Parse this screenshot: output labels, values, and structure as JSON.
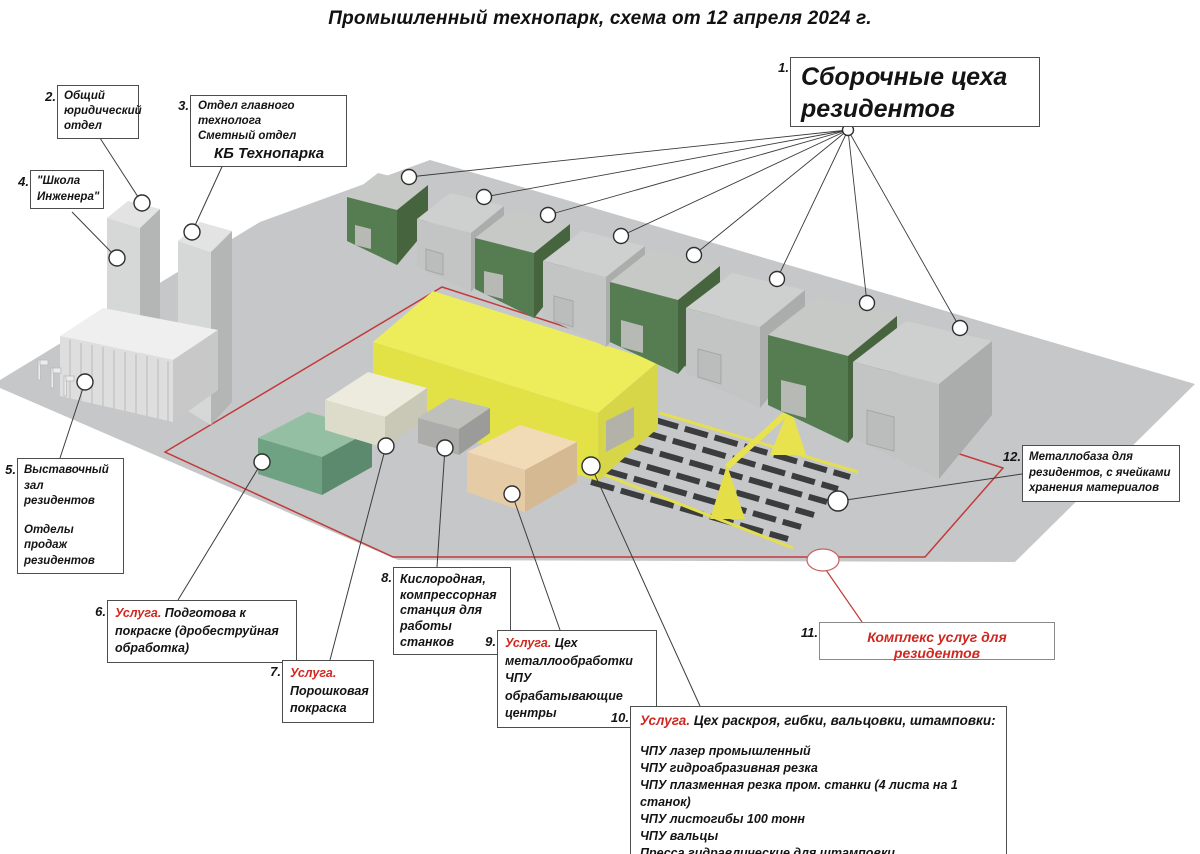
{
  "title": "Промышленный технопарк, схема от 12 апреля 2024 г.",
  "colors": {
    "service_red": "#d02820",
    "zone_outline": "#c23b3b",
    "assembly_green": "#567d52",
    "assembly_gray": "#c3c5c4",
    "main_workshop_yellow": "#e2e246"
  },
  "callouts": {
    "c1": {
      "num": "1.",
      "line1": "Сборочные цеха",
      "line2": "резидентов"
    },
    "c2": {
      "num": "2.",
      "text": "Общий юридический отдел"
    },
    "c3": {
      "num": "3.",
      "line1": "Отдел главного технолога",
      "line2": "Сметный отдел",
      "line3": "КБ Технопарка"
    },
    "c4": {
      "num": "4.",
      "line1": "\"Школа",
      "line2": "Инженера\""
    },
    "c5": {
      "num": "5.",
      "line1": "Выставочный зал",
      "line2": "резидентов",
      "line3": "Отделы продаж",
      "line4": "резидентов"
    },
    "c6": {
      "num": "6.",
      "prefix": "Услуга.",
      "text": " Подготова к покраске (дробеструйная обработка)"
    },
    "c7": {
      "num": "7.",
      "prefix": "Услуга.",
      "text": "Порошковая покраска"
    },
    "c8": {
      "num": "8.",
      "text": "Кислородная, компрессорная станция для работы станков"
    },
    "c9": {
      "num": "9.",
      "prefix": "Услуга.",
      "text": " Цех металлообработки ЧПУ обрабатывающие центры"
    },
    "c10": {
      "num": "10.",
      "prefix": "Услуга.",
      "text": " Цех раскроя, гибки, вальцовки, штамповки:",
      "items": [
        "ЧПУ лазер промышленный",
        "ЧПУ гидроабразивная резка",
        "ЧПУ плазменная резка пром. станки (4 листа на 1 станок)",
        "ЧПУ листогибы 100 тонн",
        "ЧПУ вальцы",
        "Пресса гидравлические для штамповки"
      ]
    },
    "c11": {
      "num": "11.",
      "text": "Комплекс услуг для резидентов"
    },
    "c12": {
      "num": "12.",
      "text": "Металлобаза для резидентов, с ячейками хранения материалов"
    }
  }
}
